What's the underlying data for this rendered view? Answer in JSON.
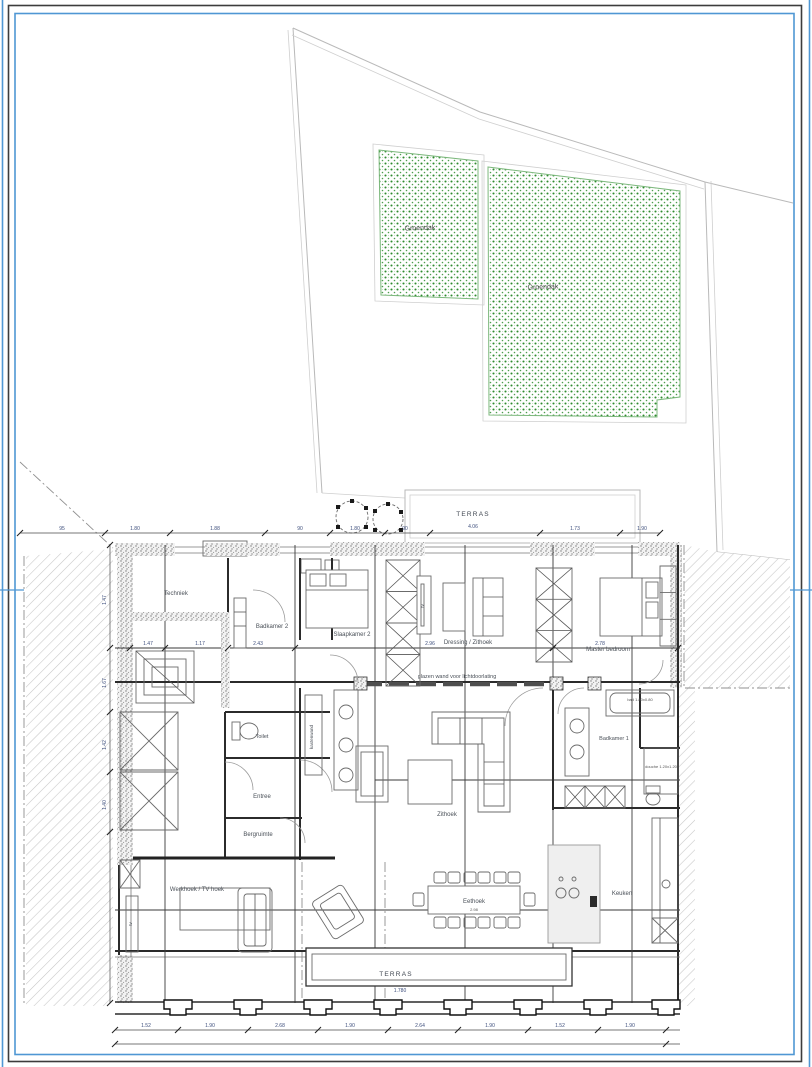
{
  "document": {
    "type": "architectural-floor-plan",
    "language": "Dutch"
  },
  "colors": {
    "frame_blue": "#4f97d4",
    "frame_black": "#3c3c3c",
    "green_roof_dot": "#2e8b2e",
    "hatch_gray": "#c6c6c6",
    "wall_dark": "#2b2b2b",
    "dim_blue": "#3d4e7c"
  },
  "labels": {
    "groendak": "Groendak",
    "terras": "TERRAS",
    "techniek": "Techniek",
    "badkamer2": "Badkamer 2",
    "slaapkamer2": "Slaapkamer 2",
    "dressing_zithoek": "Dressing / Zithoek",
    "master_bedroom": "Master bedroom",
    "glazen_wand": "glazen wand voor lichtdoorlating",
    "kastenwand": "kastenwand",
    "toilet": "Toilet",
    "badkamer1": "Badkamer 1",
    "bad": "bad 1.80x0.80",
    "douche": "douche 1.20x1.20",
    "entree": "Entree",
    "zithoek": "Zithoek",
    "bergruimte": "Bergruimte",
    "werkhoek": "Werkhoek / TV hoek",
    "eethoek": "Eethoek",
    "keuken": "Keuken",
    "tv": "tv"
  },
  "dimensions": {
    "terrace_top": "4.06",
    "terrace_bottom": "1.780",
    "eethoek_table": "2.98",
    "top": [
      "95",
      "1.80",
      "1.88",
      "90",
      "1.80",
      "90",
      "1.73",
      "1.90"
    ],
    "left": [
      "1.47",
      "1.67",
      "1.42",
      "1.40"
    ],
    "middle": [
      "1.47",
      "1.17",
      "2.43",
      "2.96",
      "2.78"
    ],
    "bottom": [
      "1.52",
      "1.90",
      "2.68",
      "1.90",
      "2.64",
      "1.90",
      "1.52",
      "1.90"
    ]
  }
}
